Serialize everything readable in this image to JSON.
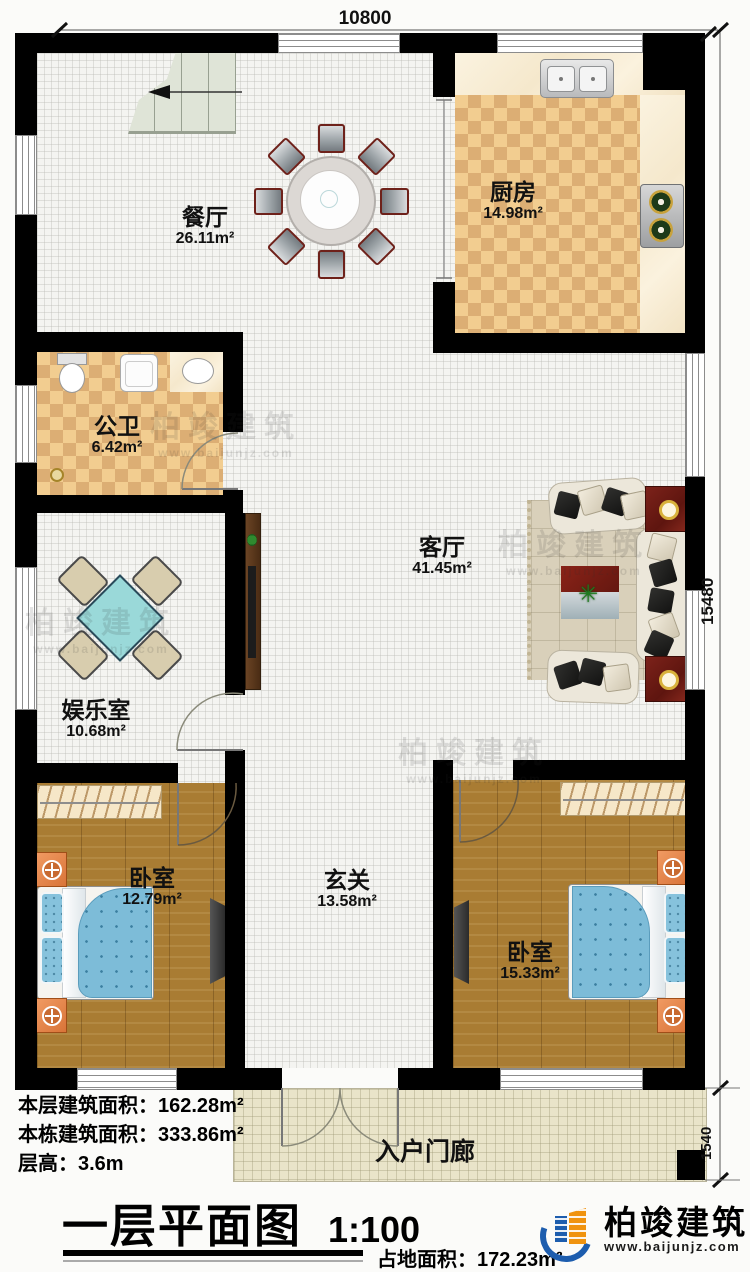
{
  "dimensions": {
    "width_top": "10800",
    "height_right": "15480",
    "porch_height": "1540"
  },
  "rooms": {
    "dining": {
      "name": "餐厅",
      "area": "26.11m²"
    },
    "kitchen": {
      "name": "厨房",
      "area": "14.98m²"
    },
    "bathroom": {
      "name": "公卫",
      "area": "6.42m²"
    },
    "living": {
      "name": "客厅",
      "area": "41.45m²"
    },
    "entertainment": {
      "name": "娱乐室",
      "area": "10.68m²"
    },
    "foyer": {
      "name": "玄关",
      "area": "13.58m²"
    },
    "bedroom_left": {
      "name": "卧室",
      "area": "12.79m²"
    },
    "bedroom_right": {
      "name": "卧室",
      "area": "15.33m²"
    },
    "porch": {
      "name": "入户门廊"
    }
  },
  "info": {
    "lines": [
      {
        "label": "本层建筑面积：",
        "value": "162.28m²"
      },
      {
        "label": "本栋建筑面积：",
        "value": "333.86m²"
      },
      {
        "label": "层高：",
        "value": "3.6m"
      }
    ],
    "title": "一层平面图",
    "scale": "1:100",
    "land_label": "占地面积：",
    "land_value": "172.23m²"
  },
  "branding": {
    "company": "柏竣建筑",
    "website": "www.baijunjz.com"
  },
  "watermark": {
    "company": "柏竣建筑",
    "website": "www.baijunjz.com"
  },
  "icons": {
    "plant": "✳"
  },
  "colors": {
    "wall": "#000000",
    "checker_light": "#f2cd90",
    "checker_dark": "#dcae74",
    "wood_floor": "#a97c33",
    "porch_floor": "#e9e4c9",
    "bed_blue": "#7dbcd8",
    "table_teal": "#9ad9d9",
    "brand_blue": "#1d5dae",
    "brand_orange": "#f0930f"
  }
}
